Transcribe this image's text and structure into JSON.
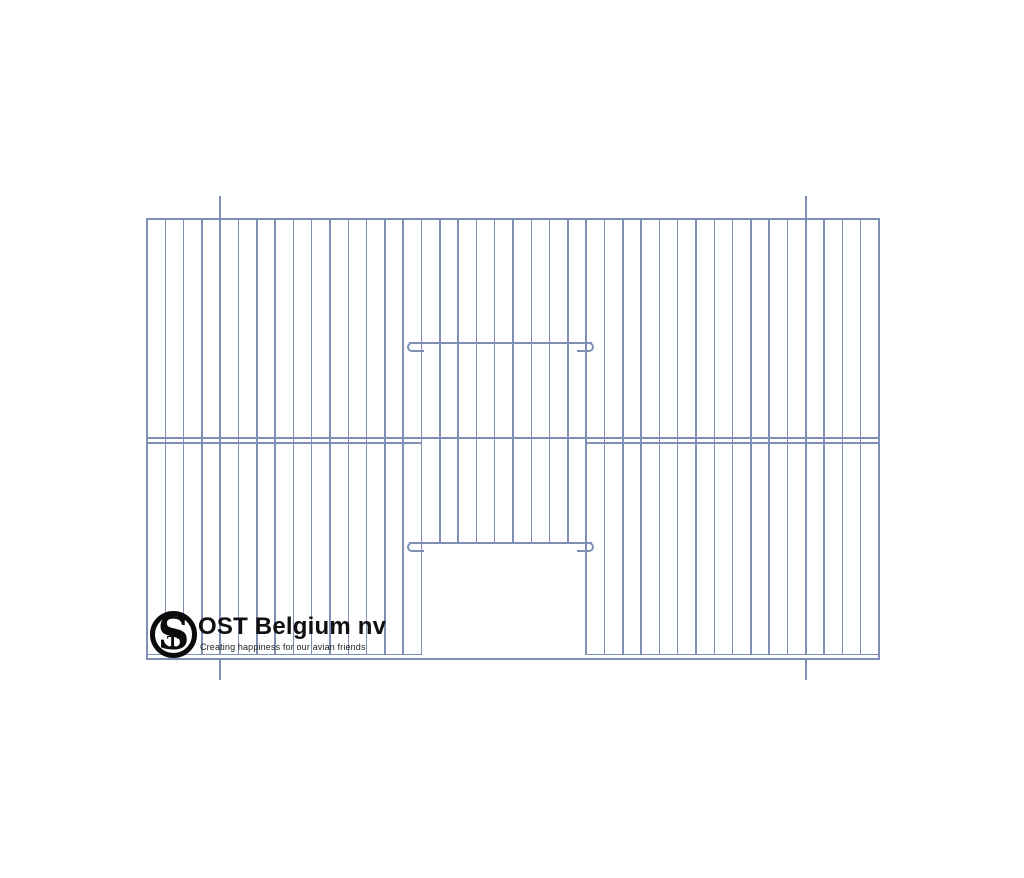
{
  "page": {
    "background": "#ffffff",
    "width": 1024,
    "height": 878
  },
  "logo": {
    "monogram": {
      "s": "S",
      "t": "T"
    },
    "name": "OST Belgium nv",
    "tagline": "Creating happiness for our avian friends",
    "ink_color": "#0b0b0b"
  },
  "drawing": {
    "description": "Technical line drawing of a wire bird-cage front panel with central sliding door opening and two slider bars with hooked ends",
    "wire_color": "#8090b4",
    "frame": {
      "left": 146,
      "top": 218,
      "right": 878,
      "bottom": 658,
      "stroke": 2
    },
    "wires": {
      "gaps": 40,
      "thickness": 1.6,
      "bottom": 655
    },
    "door": {
      "left_wire": 15,
      "right_wire": 24,
      "open_top": 543.5
    },
    "rails": {
      "middle_upper_y": 437,
      "middle_lower_y": 442.4,
      "bottom_y": 653.6,
      "thickness": 1.8
    },
    "sliders": [
      {
        "y": 341.6,
        "x1": 408.5,
        "x2": 591.5
      },
      {
        "y": 541.6,
        "x1": 408.5,
        "x2": 591.5
      }
    ],
    "slider_stroke": 2.4,
    "hook_width": 17,
    "hook_height": 10,
    "ticks": {
      "wire_indices": [
        4,
        36
      ],
      "top_y1": 196,
      "top_y2": 219,
      "bottom_y1": 660,
      "bottom_y2": 679.5
    }
  }
}
